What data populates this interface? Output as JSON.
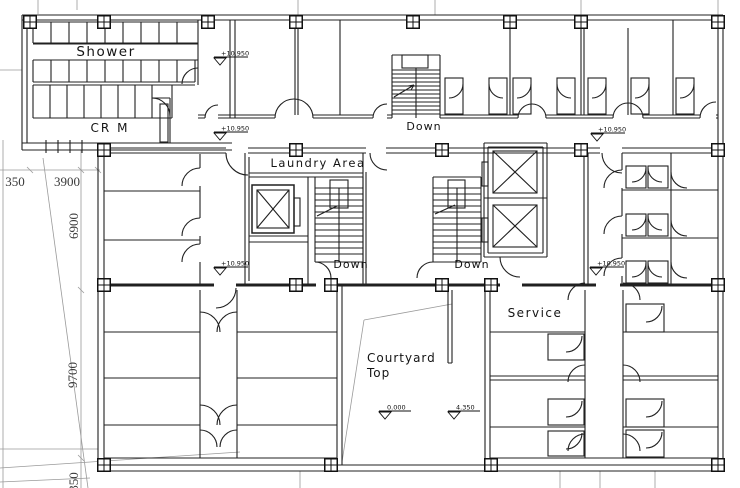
{
  "drawing": {
    "title": "floor-plan",
    "labels": {
      "shower": "Shower",
      "cr_m": "CR  M",
      "laundry_area": "Laundry Area",
      "down_top_stair": "Down",
      "down_left_stair": "Down",
      "down_right_stair": "Down",
      "courtyard_line1": "Courtyard",
      "courtyard_line2": "Top",
      "service": "Service"
    },
    "elevation_markers": {
      "level_upper_1": "+10.950",
      "level_upper_2": "+10.950",
      "level_upper_3": "+10.950",
      "level_mid_left": "+10.950",
      "level_mid_right": "+10.950",
      "courtyard_floor": "0.000",
      "courtyard_ledge": "4.350"
    },
    "dimensions": {
      "horizontal": [
        "350",
        "3900"
      ],
      "vertical": [
        "6900",
        "9700",
        "350"
      ]
    },
    "colors": {
      "line": "#202020",
      "construction": "#9a9a9a",
      "background": "#ffffff"
    }
  }
}
